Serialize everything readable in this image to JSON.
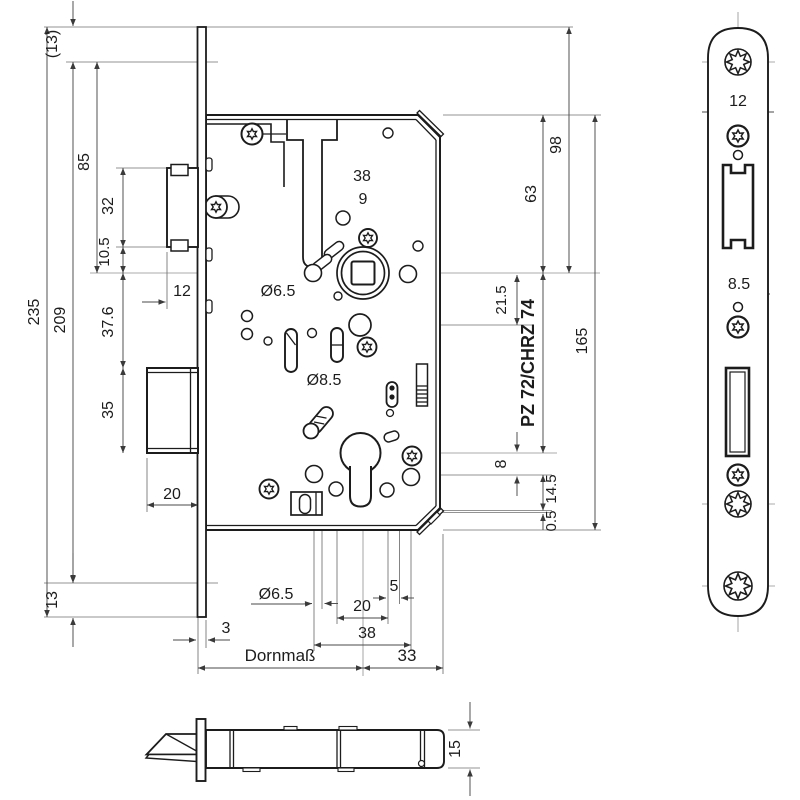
{
  "drawing": {
    "type": "technical-drawing",
    "subject": "Mortise lock with faceplate, front and side views",
    "line_color": "#1c1c1c",
    "background": "#ffffff"
  },
  "dims": {
    "overall_height": "235",
    "inner_height": "209",
    "top_offset_ref": "(13)",
    "bottom_offset": "13",
    "top_to_spindle": "85",
    "latch_height": "32",
    "latch_below": "10.5",
    "spindle_to_bolt": "37.6",
    "bolt_height": "35",
    "bolt_throw": "20",
    "latch_throw": "12",
    "hole_span_38": "38",
    "spindle_square": "9",
    "dia_6_5_upper": "Ø6.5",
    "dia_8_5": "Ø8.5",
    "dia_6_5_lower": "Ø6.5",
    "d5": "5",
    "d20": "20",
    "d38": "38",
    "backset": "Dornmaß",
    "d33": "33",
    "d3": "3",
    "faceplate_top_to_spindle": "98",
    "case_top_to_spindle": "63",
    "case_height": "165",
    "d21_5": "21.5",
    "lock_center": "PZ 72/CHRZ 74",
    "d8": "8",
    "d14_5": "14.5",
    "d0_5": "0.5",
    "faceplate": {
      "latch_slot_width": "12",
      "bolt_slot_width": "8.5"
    },
    "side": {
      "case_thickness": "15"
    }
  }
}
